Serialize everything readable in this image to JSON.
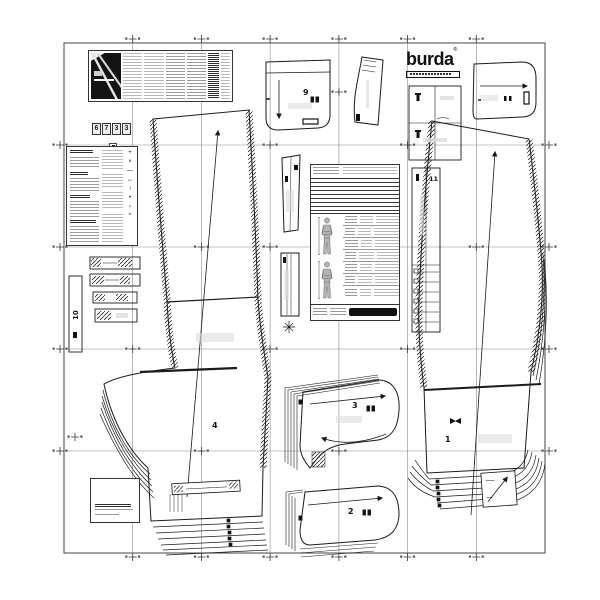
{
  "document": {
    "kind": "sewing pattern cutting sheet",
    "brand": "burda"
  },
  "colors": {
    "ink": "#1a1a1a",
    "grid": "#777777",
    "shade": "#bbbbbb",
    "paper": "#ffffff"
  },
  "logo": {
    "text": "burda",
    "registered": "®"
  },
  "badge": {
    "digits": [
      "6",
      "7",
      "3",
      "3"
    ]
  },
  "pieces": {
    "front_leg_number": "4",
    "back_leg_number": "1",
    "pocket_number": "9",
    "facing_upper_number": "3",
    "facing_lower_number": "2",
    "strip_left_number": "10",
    "strip_right_number": "11"
  },
  "legend": {
    "symbols": [
      "+",
      "×",
      "—",
      "↔",
      "↑",
      "•",
      "›",
      "^"
    ]
  }
}
